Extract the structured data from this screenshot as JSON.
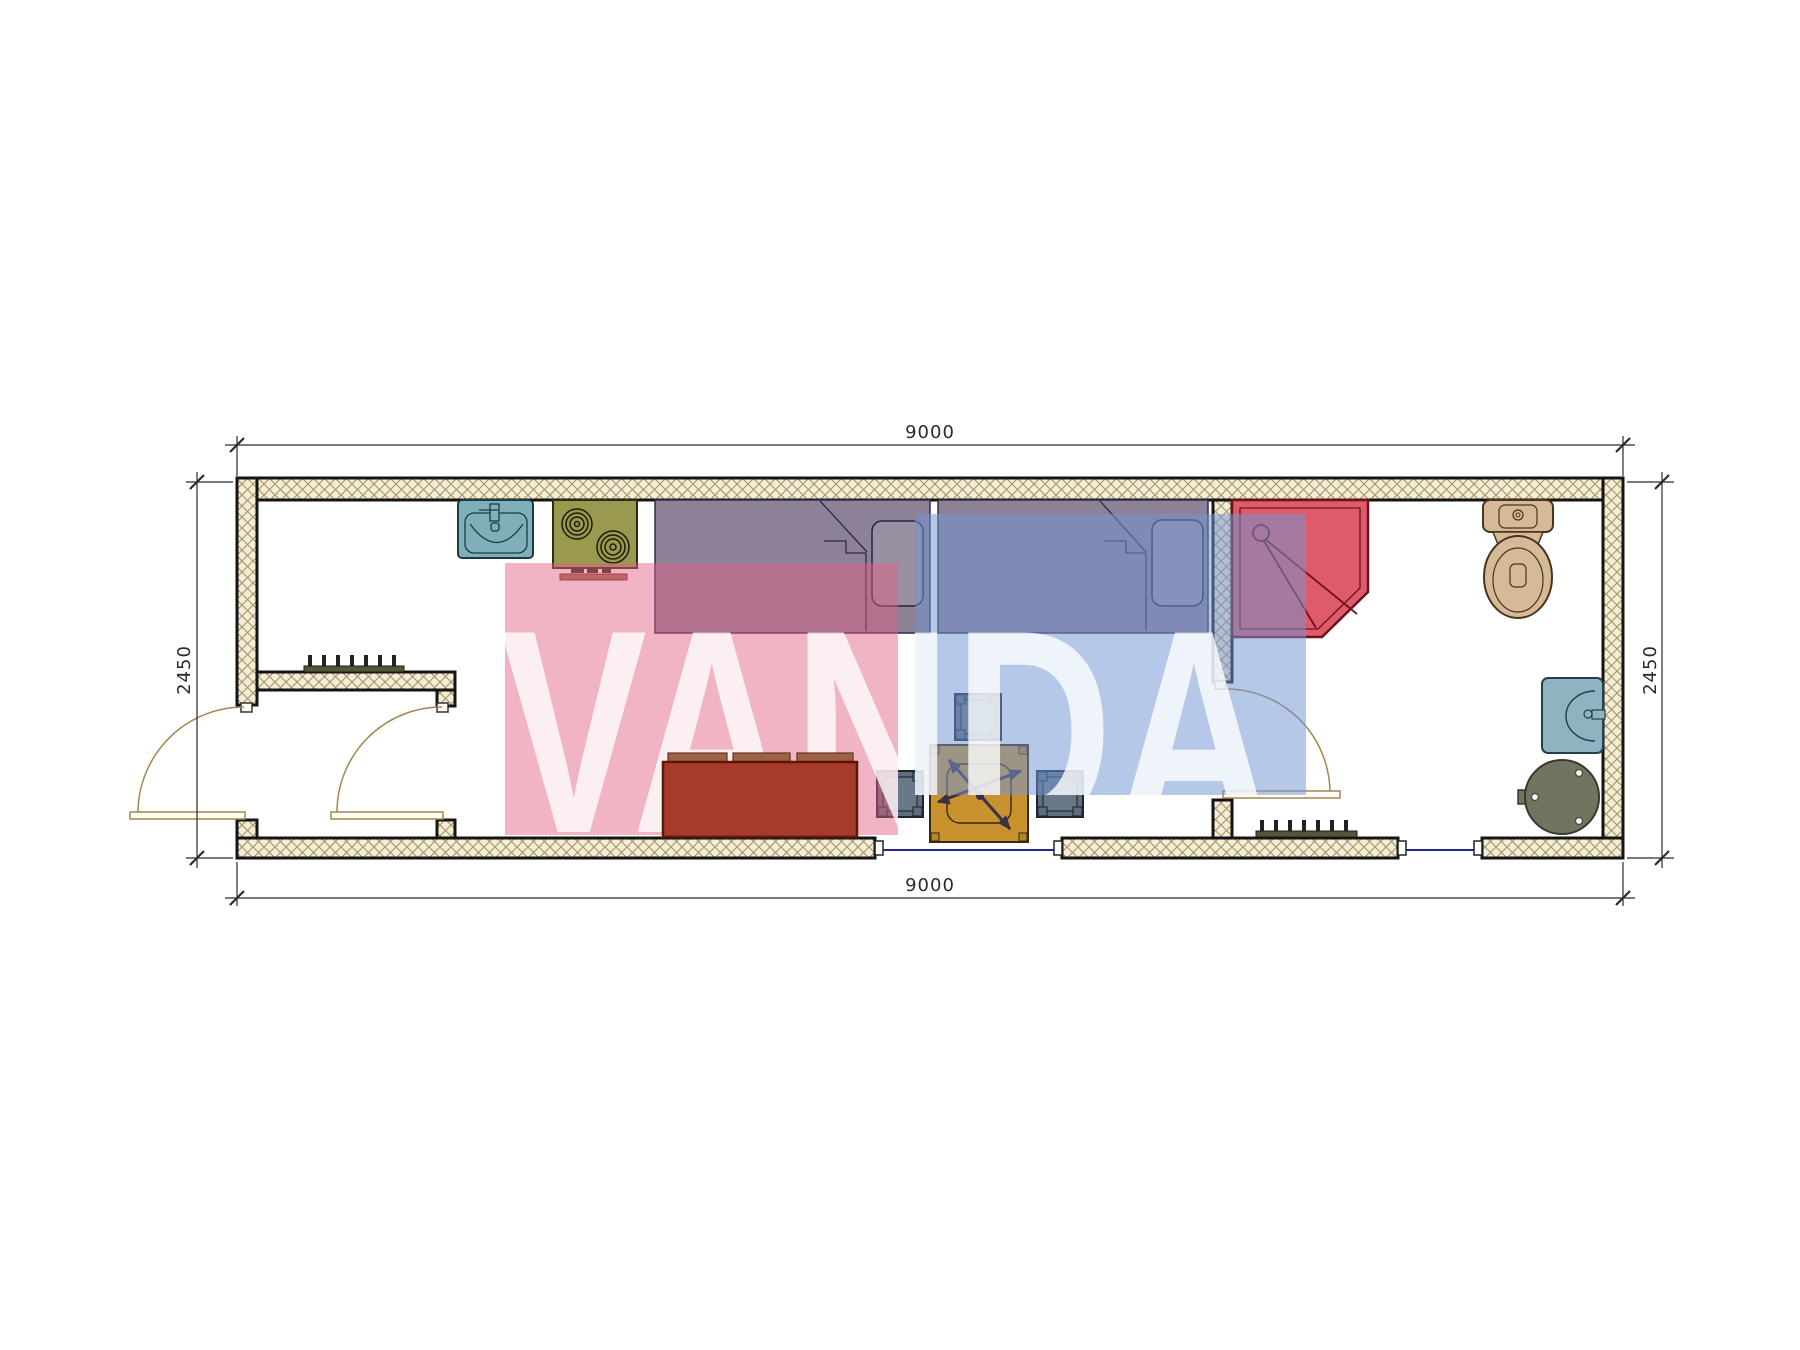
{
  "drawing": {
    "type": "architectural-floor-plan",
    "dims": {
      "top": "9000",
      "bottom": "9000",
      "left": "2450",
      "right": "2450"
    },
    "watermark": {
      "text": "VANDA",
      "pink": "#e15f82",
      "blue": "#7396d2"
    },
    "colors": {
      "wall_hatch": "#a8945f",
      "wall_edge": "#141414",
      "kitchen_sink": "#7fb0ba",
      "stove": "#99994f",
      "bed": "#8d8197",
      "shower": "#dc5361",
      "toilet": "#d6ba98",
      "washbasin": "#8fb3c0",
      "water_heater": "#71755f",
      "sofa": "#a63b2a",
      "table": "#c8932f",
      "stool": "#5e6e7e",
      "radiator": "#55553c",
      "door_arc": "#a5854e",
      "window_glazing": "#28288c"
    },
    "symbols": [
      "kitchen-sink",
      "stove",
      "bed-1",
      "bed-2",
      "shower-cabin",
      "toilet",
      "washbasin",
      "water-heater",
      "sofa",
      "folding-table",
      "stool-top",
      "stool-left",
      "stool-right",
      "radiator-hall",
      "radiator-bath",
      "entrance-door",
      "hall-door",
      "bathroom-door",
      "window-living",
      "window-bath"
    ]
  }
}
